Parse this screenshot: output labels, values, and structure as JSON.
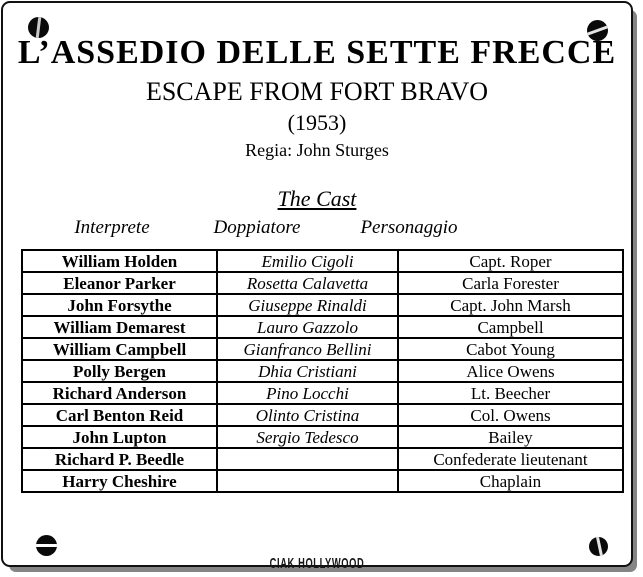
{
  "page": {
    "title_italian": "L’ASSEDIO DELLE SETTE FRECCE",
    "title_english": "ESCAPE FROM FORT BRAVO",
    "year": "(1953)",
    "director": "Regia: John Sturges",
    "section_heading": "The Cast",
    "watermark": "CIAK HOLLYWOOD"
  },
  "icons": {
    "corner_screws": [
      "screw-icon-top-left",
      "screw-icon-top-right",
      "screw-icon-bottom-left",
      "screw-icon-bottom-right"
    ]
  },
  "colors": {
    "background": "#ffffff",
    "text": "#000000",
    "table_border": "#000000",
    "card_border": "#111111",
    "shadow": "#858585"
  },
  "cast_table": {
    "columns": [
      "Interprete",
      "Doppiatore",
      "Personaggio"
    ],
    "rows": [
      {
        "interprete": "William Holden",
        "doppiatore": "Emilio Cigoli",
        "personaggio": "Capt. Roper"
      },
      {
        "interprete": "Eleanor Parker",
        "doppiatore": "Rosetta Calavetta",
        "personaggio": "Carla Forester"
      },
      {
        "interprete": "John Forsythe",
        "doppiatore": "Giuseppe Rinaldi",
        "personaggio": "Capt. John Marsh"
      },
      {
        "interprete": "William Demarest",
        "doppiatore": "Lauro Gazzolo",
        "personaggio": "Campbell"
      },
      {
        "interprete": "William Campbell",
        "doppiatore": "Gianfranco Bellini",
        "personaggio": "Cabot Young"
      },
      {
        "interprete": "Polly Bergen",
        "doppiatore": "Dhia Cristiani",
        "personaggio": "Alice Owens"
      },
      {
        "interprete": "Richard Anderson",
        "doppiatore": "Pino Locchi",
        "personaggio": "Lt. Beecher"
      },
      {
        "interprete": "Carl Benton Reid",
        "doppiatore": "Olinto Cristina",
        "personaggio": "Col. Owens"
      },
      {
        "interprete": "John Lupton",
        "doppiatore": "Sergio Tedesco",
        "personaggio": "Bailey"
      },
      {
        "interprete": "Richard P. Beedle",
        "doppiatore": "",
        "personaggio": "Confederate lieutenant"
      },
      {
        "interprete": "Harry Cheshire",
        "doppiatore": "",
        "personaggio": "Chaplain"
      }
    ]
  }
}
